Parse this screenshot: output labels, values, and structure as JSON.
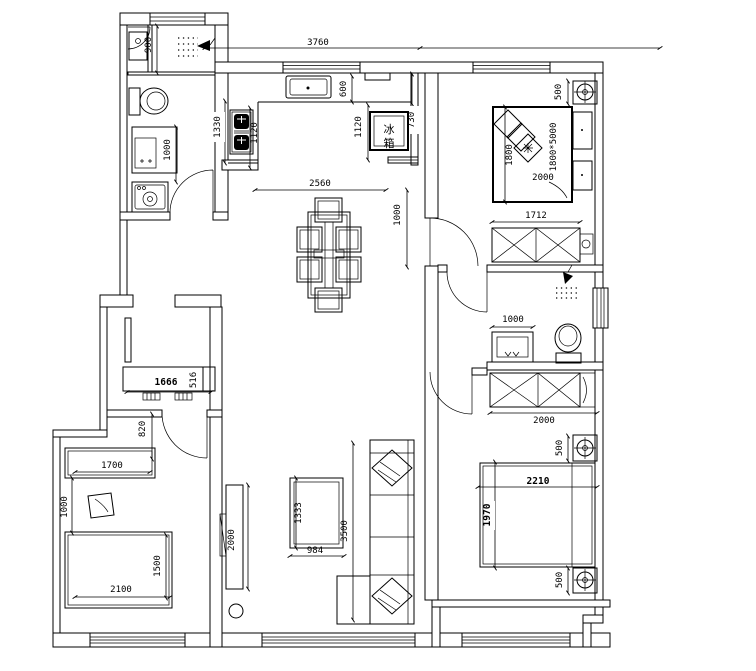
{
  "drawing": {
    "kind": "apartment floor plan (CAD line drawing)",
    "line_color": "#000000",
    "background": "#ffffff"
  },
  "labels": {
    "fridge_char_top": "冰",
    "fridge_char_bottom": "箱"
  },
  "dims": {
    "shower_depth": "900",
    "top_width": "3760",
    "counter_depth": "600",
    "stove_col_left": "1330",
    "stove_col_right": "1120",
    "fridge_col": "1120",
    "fridge_width": "730",
    "kitchen_opening": "2560",
    "dining_wall": "1000",
    "bath1_vanity": "1000",
    "br1_nightstand": "500",
    "br1_bed_w": "1800",
    "br1_bed_spec": "1800*5000",
    "br1_bed_l": "2000",
    "br1_wardrobe": "1712",
    "bath2_vanity": "1000",
    "br2_wardrobe": "2000",
    "br2_ns_top": "500",
    "br2_bed_w": "2210",
    "br2_bed_l": "1970",
    "br2_ns_bottom": "500",
    "hall_cabinet_l": "1666",
    "hall_cabinet_d": "516",
    "hall_opening": "820",
    "study_desk": "1700",
    "study_gap": "1000",
    "lb_bed_l": "2100",
    "lb_bed_w": "1500",
    "tv_cabinet": "2000",
    "table_l": "1333",
    "table_w": "984",
    "sofa_l": "3500"
  }
}
